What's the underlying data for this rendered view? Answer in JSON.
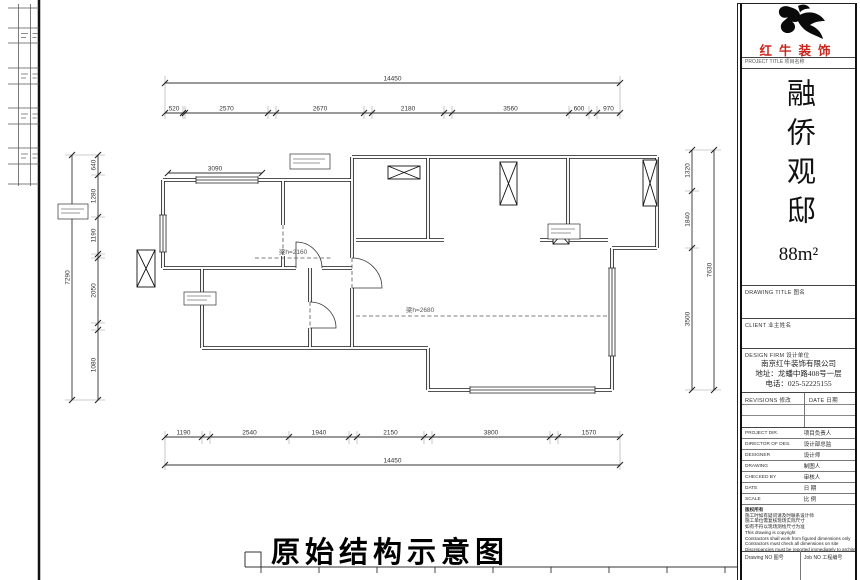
{
  "plan": {
    "title": "原始结构示意图",
    "dims": {
      "top_overall": "14450",
      "top": [
        "520",
        "2570",
        "2670",
        "2180",
        "3560",
        "600",
        "970"
      ],
      "bottom": [
        "1190",
        "2540",
        "1940",
        "2150",
        "3800",
        "1570"
      ],
      "bottom_overall": "14450",
      "left_overall": "7290",
      "left": [
        "640",
        "1280",
        "1190",
        "2050",
        "1080"
      ],
      "right": [
        "1320",
        "1840",
        "3500"
      ],
      "right_overall": "7630",
      "interior": "3090"
    },
    "beam_label_1": "梁h=2160",
    "beam_label_2": "梁h=2680"
  },
  "titleblock": {
    "logo_name": "红牛装饰",
    "logo_color": "#c9251c",
    "project_title_label": "PROJECT TITLE 项目名称",
    "project_name": "融侨观邸",
    "project_area": "88m²",
    "drawing_title_label": "DRAWING TITLE 图名",
    "client_label": "CLIENT 业主姓名",
    "design_firm_label": "DESIGN FIRM 设计单位",
    "firm_name": "南京红牛装饰有限公司",
    "firm_address": "地址：龙蟠中路408号一层",
    "firm_phone": "电话：025-52225155",
    "revisions_label": "REVISIONS 修改",
    "revisions_date_label": "DATE 日期",
    "rows": [
      {
        "en": "PROJECT DIR.",
        "zh": "项目负责人"
      },
      {
        "en": "DIRECTOR OF DES.",
        "zh": "设计部总监"
      },
      {
        "en": "DESIGNER",
        "zh": "设计师"
      },
      {
        "en": "DRAWING",
        "zh": "制图人"
      },
      {
        "en": "CHECKED BY",
        "zh": "审核人"
      },
      {
        "en": "DATE",
        "zh": "日 期"
      },
      {
        "en": "SCALE",
        "zh": "比 例"
      }
    ],
    "notes": [
      "版权所有",
      "施工时如有疑问请及时联系设计师",
      "施工单位需复核现场实际尺寸",
      "如有不符以现场测绘尺寸为准",
      "This drawing is copyright",
      "Contractors shall work from figured dimensions only",
      "Contractors must check all dimensions on site",
      "Discrepancies must be reported immediately to architects"
    ],
    "drawing_no_label": "Drawing NO 图号",
    "job_no_label": "Job NO 工程编号"
  }
}
